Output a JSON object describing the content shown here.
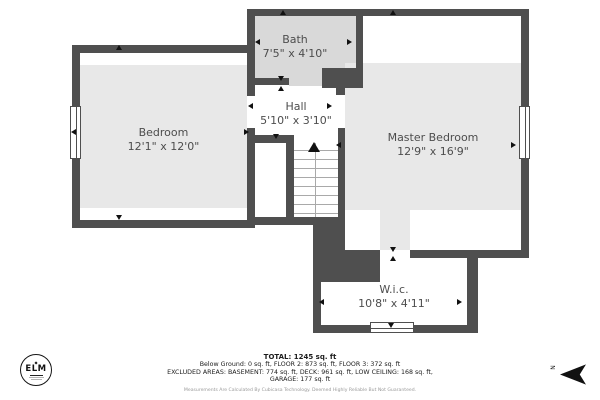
{
  "floorplan": {
    "rooms": [
      {
        "name": "Bedroom",
        "dims": "12'1\" x 12'0\""
      },
      {
        "name": "Bath",
        "dims": "7'5\" x 4'10\""
      },
      {
        "name": "Hall",
        "dims": "5'10\" x 3'10\""
      },
      {
        "name": "Master Bedroom",
        "dims": "12'9\" x 16'9\""
      },
      {
        "name": "W.i.c.",
        "dims": "10'8\" x 4'11\""
      }
    ],
    "colors": {
      "wall": "#4f4f4f",
      "room_fill": "#e8e8e8",
      "bath_fill": "#d9d9d9",
      "label_text": "#4d4d4d"
    }
  },
  "footer": {
    "total": "TOTAL: 1245 sq. ft",
    "floors_line": "Below Ground: 0 sq. ft, FLOOR 2: 873 sq. ft, FLOOR 3: 372 sq. ft",
    "excluded_line": "EXCLUDED AREAS: BASEMENT: 774 sq. ft, DECK: 961 sq. ft, LOW CEILING: 168 sq. ft,",
    "garage_line": "GARAGE: 177 sq. ft",
    "disclaimer": "Measurements Are Calculated By Cubicasa Technology. Deemed Highly Reliable But Not Guaranteed."
  },
  "logo": {
    "text": "ELM"
  },
  "compass": {
    "label": "N"
  }
}
